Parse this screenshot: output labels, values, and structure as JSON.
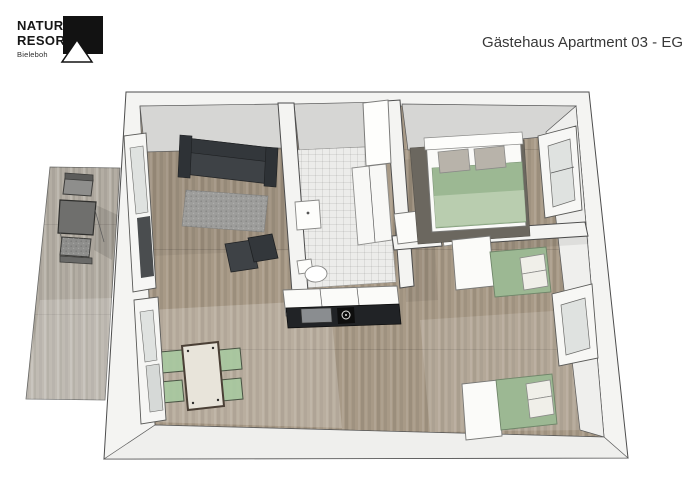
{
  "header": {
    "logo": {
      "line1": "NATUR",
      "line2": "RESORT",
      "subtitle": "Bieleboh"
    },
    "title": "Gästehaus Apartment 03 - EG"
  },
  "colors": {
    "wall": "#f4f4f2",
    "wall_face_gray": "#d6d6d4",
    "wall_face_light": "#efefed",
    "floor_wood": "#a89a87",
    "terrace_deck": "#b3ada3",
    "tile": "#ececea",
    "sofa_dark": "#3e4246",
    "sofa_back": "#33373b",
    "rug_gray": "#9d9d9b",
    "bedroom_rug": "#6b675f",
    "bed_green": "#9cb893",
    "bed_green_light": "#bccfb2",
    "chair_green": "#a8c9a0",
    "pillow_gray": "#b8b3aa",
    "pillow_white": "#f0efe9",
    "white_furniture": "#fbfbf9",
    "counter_top": "#212326",
    "kitchen_sink": "#8a8d90",
    "window_glass": "#4a4d4f",
    "glass_light": "#dfe2e0",
    "outdoor_table": "#6f6f6d",
    "outdoor_chair": "#8e8e8c"
  },
  "floorplan": {
    "rooms": [
      "terrace",
      "living-dining-room",
      "kitchen",
      "bathroom",
      "hallway",
      "bedroom-1",
      "bedroom-2"
    ]
  }
}
